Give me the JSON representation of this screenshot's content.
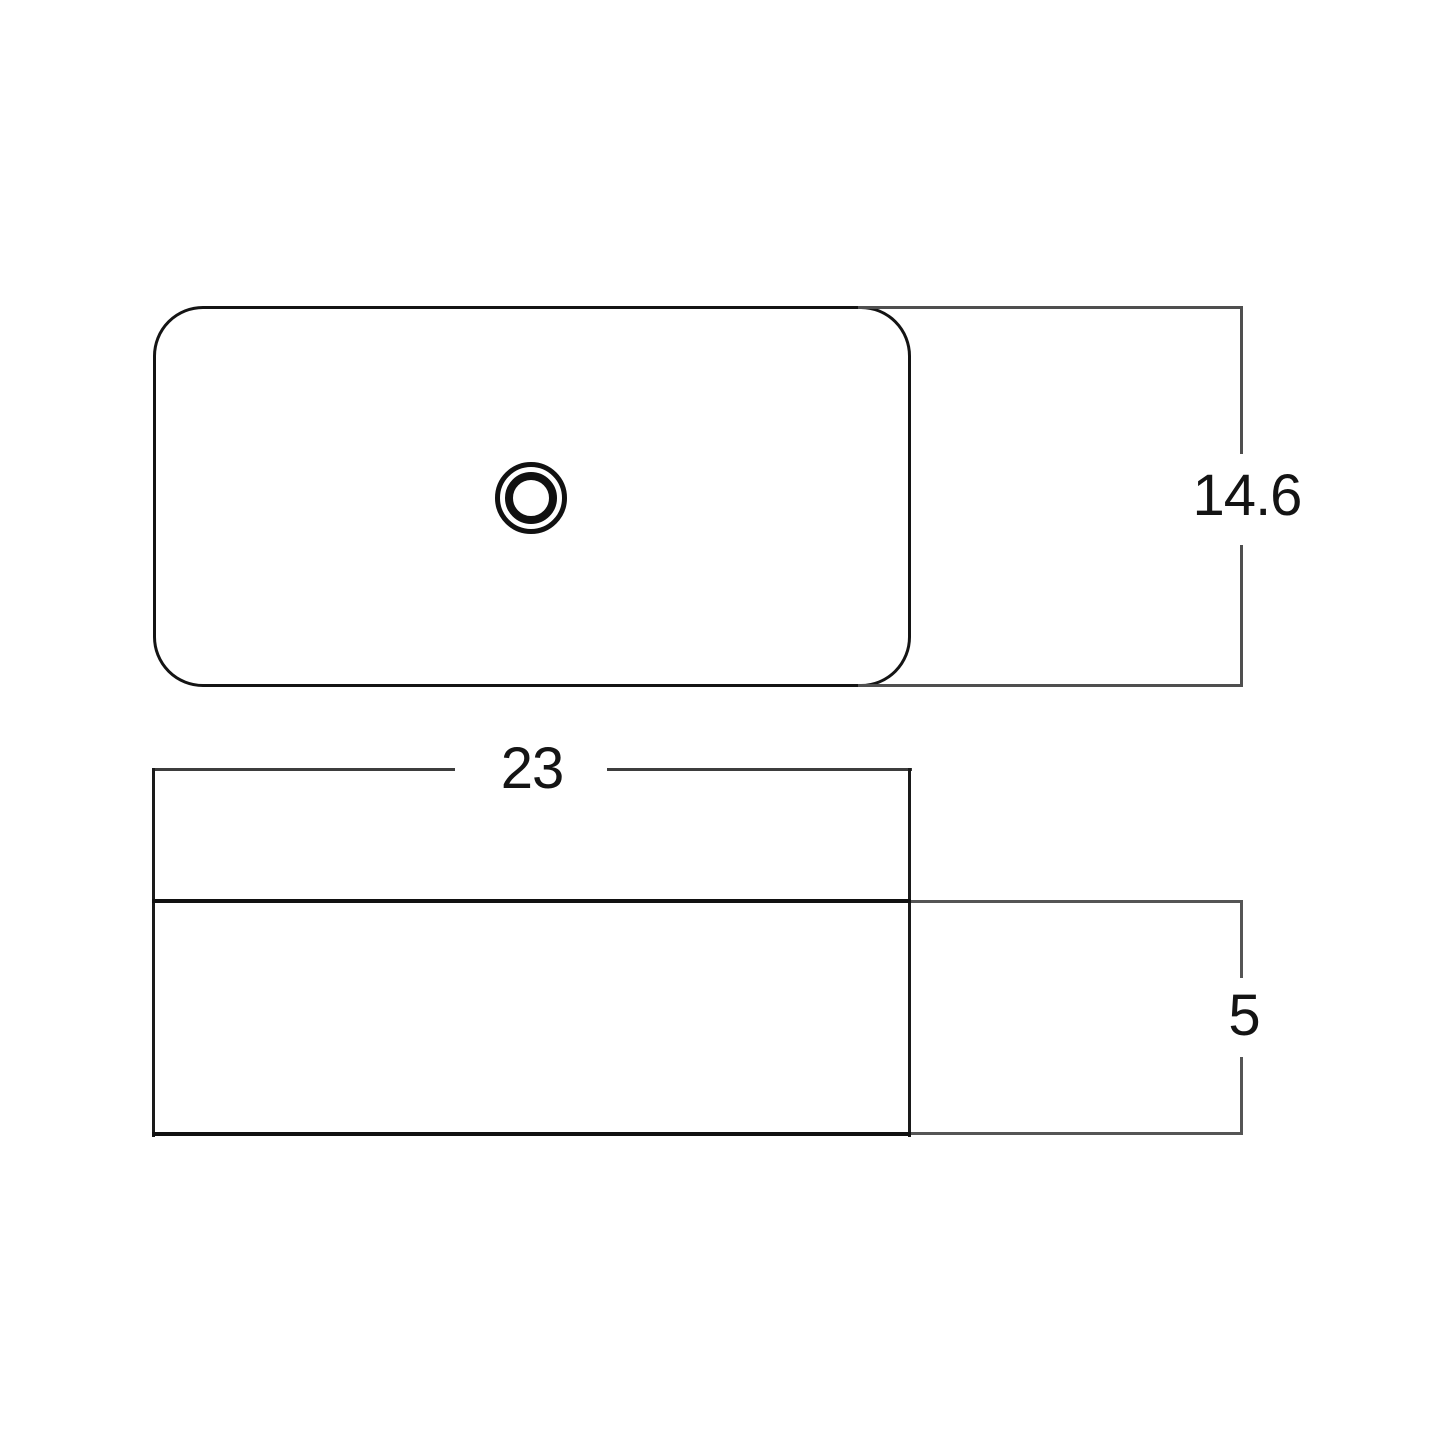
{
  "drawing": {
    "background_color": "#ffffff",
    "outline_color": "#141414",
    "dimension_line_color": "#4f4f4f",
    "label_color": "#141414"
  },
  "dimensions": {
    "depth": "14.6",
    "width": "23",
    "height": "5"
  }
}
